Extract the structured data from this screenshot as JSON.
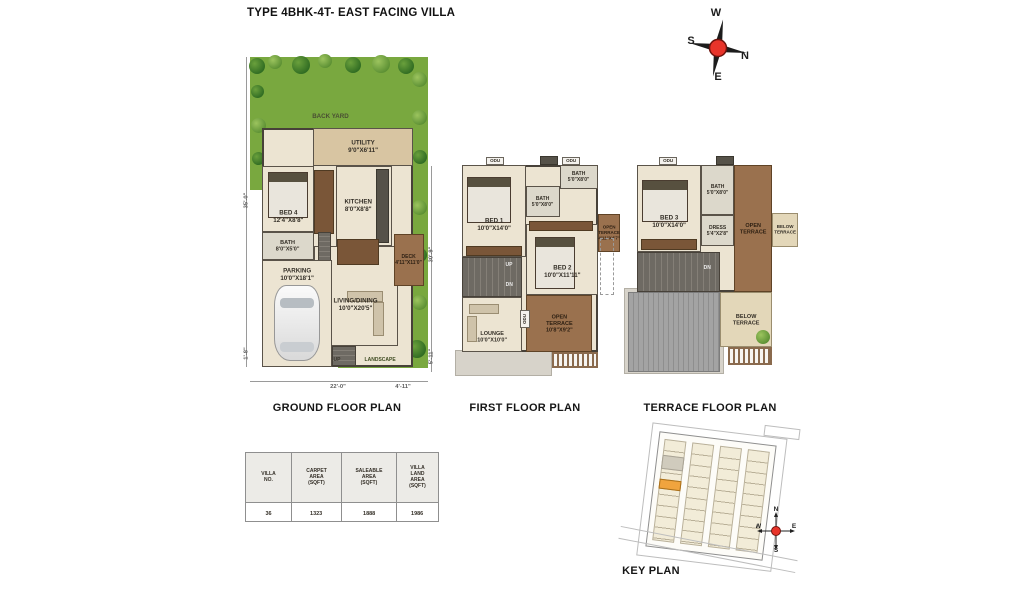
{
  "title": "TYPE 4BHK-4T- EAST FACING VILLA",
  "compass": {
    "w": "W",
    "s": "S",
    "n": "N",
    "e": "E"
  },
  "colors": {
    "grass": "#79A83F",
    "terrace_wood": "#9A714E",
    "wall": "#474139",
    "compass_red": "#E8342A",
    "highlight_plot": "#F0A43E"
  },
  "ground_floor": {
    "label": "GROUND FLOOR PLAN",
    "backyard": "BACK YARD",
    "rooms": {
      "utility": "UTILITY\n9'0\"X6'11\"",
      "bed4": "BED 4\n12'4\"X8'8\"",
      "kitchen": "KITCHEN\n8'0\"X8'8\"",
      "bath": "BATH\n8'0\"X5'0\"",
      "living_dining": "LIVING/DINING\n10'0\"X20'5\"",
      "parking": "PARKING\n10'0\"X18'1\"",
      "deck": "DECK\n4'11\"X11'0\"",
      "landscape": "LANDSCAPE",
      "up_stairs": "UP",
      "up_entry": "UP"
    },
    "dims": {
      "left": "35'-0\"",
      "left_bottom": "1'-8\"",
      "bottom": "22'-0\"",
      "bottom_right": "4'-11\"",
      "right": "30'-9\"",
      "right_bottom": "5'-11\""
    }
  },
  "first_floor": {
    "label": "FIRST FLOOR PLAN",
    "rooms": {
      "odu_left": "ODU",
      "odu_right": "ODU",
      "odu_side": "ODU",
      "bed1": "BED 1\n10'0\"X14'0\"",
      "bath_mid": "BATH\n5'0\"X8'0\"",
      "bath_top": "BATH\n5'0\"X8'0\"",
      "bed2": "BED 2\n10'0\"X11'11\"",
      "open_terrace_small": "OPEN\nTERRACE\n4'11\"X4'7\"",
      "lounge": "LOUNGE\n10'0\"X10'0\"",
      "open_terrace": "OPEN\nTERRACE\n10'8\"X9'2\"",
      "up": "UP",
      "dn": "DN"
    }
  },
  "terrace_floor": {
    "label": "TERRACE FLOOR PLAN",
    "rooms": {
      "odu": "ODU",
      "bed3": "BED 3\n10'0\"X14'0\"",
      "bath": "BATH\n5'0\"X8'0\"",
      "dress": "DRESS\n5'4\"X2'8\"",
      "open_terrace": "OPEN\nTERRACE",
      "below_terrace_side": "BELOW\nTERRACE",
      "below_terrace": "BELOW\nTERRACE",
      "dn": "DN"
    }
  },
  "area_table": {
    "headers": [
      "VILLA NO.",
      "CARPET AREA\n(SQFT)",
      "SALEABLE AREA\n(SQFT)",
      "VILLA\nLAND AREA\n(SQFT)"
    ],
    "row": [
      "36",
      "1323",
      "1888",
      "1986"
    ]
  },
  "key_plan": {
    "label": "KEY PLAN",
    "compass": {
      "n": "N",
      "s": "S",
      "e": "E",
      "w": "W"
    }
  }
}
